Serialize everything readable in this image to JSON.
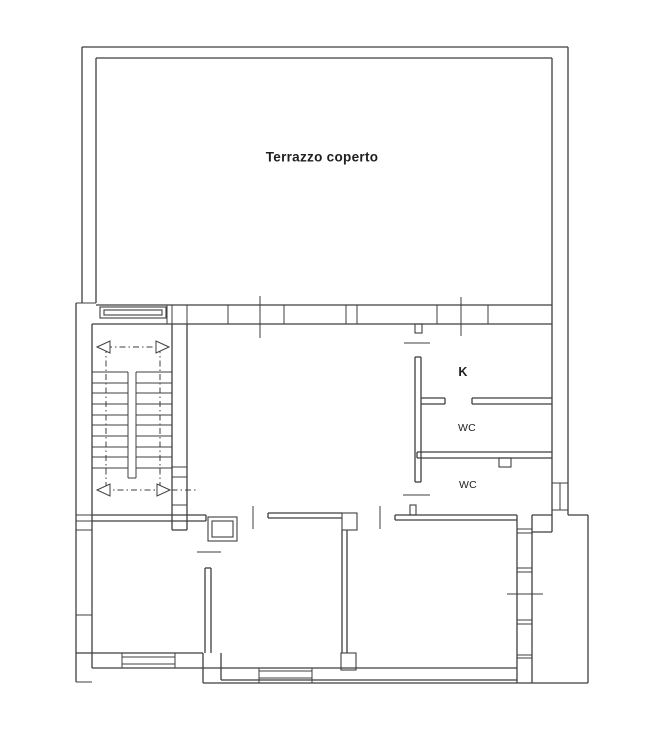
{
  "document": {
    "type": "architectural floor plan",
    "background": "#ffffff"
  },
  "colors": {
    "background": "#ffffff",
    "line": "#3f3f3f",
    "label": "#1e1e1e"
  },
  "labels": [
    {
      "id": "terrace",
      "text": "Terrazzo coperto",
      "x": 322,
      "y": 157,
      "size": 13.5,
      "weight": "bold"
    },
    {
      "id": "kitchen",
      "text": "K",
      "x": 463,
      "y": 372,
      "size": 12.5,
      "weight": "bold"
    },
    {
      "id": "wc-upper",
      "text": "WC",
      "x": 467,
      "y": 428,
      "size": 10.5,
      "weight": "normal"
    },
    {
      "id": "wc-lower",
      "text": "WC",
      "x": 468,
      "y": 485,
      "size": 10.5,
      "weight": "normal"
    }
  ],
  "geometry": {
    "canvas": {
      "w": 662,
      "h": 738
    },
    "wall_lines": [
      [
        82,
        47,
        568,
        47
      ],
      [
        96,
        58,
        552,
        58
      ],
      [
        82,
        47,
        82,
        303
      ],
      [
        96,
        58,
        96,
        303
      ],
      [
        568,
        47,
        568,
        515
      ],
      [
        552,
        58,
        552,
        532
      ],
      [
        96,
        305,
        552,
        305
      ],
      [
        92,
        324,
        552,
        324
      ],
      [
        76,
        303,
        76,
        682
      ],
      [
        92,
        324,
        92,
        668
      ],
      [
        172,
        324,
        172,
        530
      ],
      [
        187,
        324,
        187,
        530
      ],
      [
        172,
        530,
        187,
        530
      ],
      [
        92,
        515,
        206,
        515
      ],
      [
        92,
        521,
        206,
        521
      ],
      [
        206,
        515,
        206,
        521
      ],
      [
        268,
        513,
        342,
        513
      ],
      [
        268,
        518,
        342,
        518
      ],
      [
        268,
        513,
        268,
        518
      ],
      [
        342,
        530,
        342,
        653
      ],
      [
        347,
        530,
        347,
        653
      ],
      [
        395,
        515,
        517,
        515
      ],
      [
        395,
        520,
        517,
        520
      ],
      [
        395,
        515,
        395,
        520
      ],
      [
        415,
        357,
        415,
        482
      ],
      [
        421,
        357,
        421,
        482
      ],
      [
        415,
        357,
        421,
        357
      ],
      [
        415,
        482,
        421,
        482
      ],
      [
        421,
        398,
        445,
        398
      ],
      [
        421,
        404,
        445,
        404
      ],
      [
        445,
        398,
        445,
        404
      ],
      [
        472,
        398,
        552,
        398
      ],
      [
        472,
        404,
        552,
        404
      ],
      [
        472,
        398,
        472,
        404
      ],
      [
        417,
        452,
        552,
        452
      ],
      [
        417,
        458,
        552,
        458
      ],
      [
        417,
        452,
        417,
        458
      ],
      [
        517,
        515,
        517,
        683
      ],
      [
        532,
        515,
        532,
        683
      ],
      [
        532,
        515,
        552,
        515
      ],
      [
        532,
        532,
        552,
        532
      ],
      [
        568,
        515,
        588,
        515
      ],
      [
        588,
        515,
        588,
        683
      ],
      [
        76,
        653,
        203,
        653
      ],
      [
        92,
        668,
        517,
        668
      ],
      [
        221,
        680,
        517,
        680
      ],
      [
        203,
        683,
        588,
        683
      ],
      [
        203,
        653,
        203,
        683
      ],
      [
        221,
        653,
        221,
        680
      ],
      [
        205,
        568,
        205,
        653
      ],
      [
        211,
        568,
        211,
        653
      ],
      [
        205,
        568,
        211,
        568
      ]
    ],
    "thin_lines": [
      [
        167,
        305,
        167,
        324
      ],
      [
        172,
        305,
        172,
        324
      ],
      [
        187,
        305,
        187,
        324
      ],
      [
        228,
        305,
        228,
        324
      ],
      [
        284,
        305,
        284,
        324
      ],
      [
        346,
        305,
        346,
        324
      ],
      [
        357,
        305,
        357,
        324
      ],
      [
        437,
        305,
        437,
        324
      ],
      [
        488,
        305,
        488,
        324
      ],
      [
        260,
        296,
        260,
        338
      ],
      [
        461,
        297,
        461,
        336
      ],
      [
        76,
        303,
        96,
        303
      ],
      [
        76,
        515,
        92,
        515
      ],
      [
        76,
        521,
        92,
        521
      ],
      [
        76,
        530,
        92,
        530
      ],
      [
        76,
        615,
        92,
        615
      ],
      [
        76,
        682,
        92,
        682
      ],
      [
        172,
        467,
        187,
        467
      ],
      [
        172,
        477,
        187,
        477
      ],
      [
        172,
        505,
        187,
        505
      ],
      [
        172,
        515,
        187,
        515
      ],
      [
        92,
        372,
        128,
        372
      ],
      [
        92,
        383,
        128,
        383
      ],
      [
        92,
        393,
        128,
        393
      ],
      [
        92,
        404,
        128,
        404
      ],
      [
        92,
        415,
        128,
        415
      ],
      [
        92,
        425,
        128,
        425
      ],
      [
        92,
        436,
        128,
        436
      ],
      [
        92,
        447,
        128,
        447
      ],
      [
        92,
        457,
        128,
        457
      ],
      [
        92,
        468,
        128,
        468
      ],
      [
        136,
        372,
        172,
        372
      ],
      [
        136,
        383,
        172,
        383
      ],
      [
        136,
        393,
        172,
        393
      ],
      [
        136,
        404,
        172,
        404
      ],
      [
        136,
        415,
        172,
        415
      ],
      [
        136,
        425,
        172,
        425
      ],
      [
        136,
        436,
        172,
        436
      ],
      [
        136,
        447,
        172,
        447
      ],
      [
        136,
        457,
        172,
        457
      ],
      [
        136,
        468,
        172,
        468
      ],
      [
        128,
        372,
        128,
        478
      ],
      [
        136,
        372,
        136,
        478
      ],
      [
        128,
        478,
        136,
        478
      ],
      [
        197,
        552,
        221,
        552
      ],
      [
        253,
        506,
        253,
        529
      ],
      [
        380,
        506,
        380,
        529
      ],
      [
        404,
        343,
        430,
        343
      ],
      [
        403,
        495,
        430,
        495
      ],
      [
        552,
        483,
        568,
        483
      ],
      [
        552,
        510,
        568,
        510
      ],
      [
        560,
        483,
        560,
        510
      ],
      [
        517,
        529,
        532,
        529
      ],
      [
        517,
        533,
        532,
        533
      ],
      [
        517,
        568,
        532,
        568
      ],
      [
        517,
        572,
        532,
        572
      ],
      [
        517,
        620,
        532,
        620
      ],
      [
        517,
        624,
        532,
        624
      ],
      [
        517,
        655,
        532,
        655
      ],
      [
        517,
        658,
        532,
        658
      ],
      [
        507,
        594,
        543,
        594
      ],
      [
        122,
        657,
        175,
        657
      ],
      [
        122,
        664,
        175,
        664
      ],
      [
        122,
        653,
        122,
        668
      ],
      [
        175,
        653,
        175,
        668
      ],
      [
        259,
        671,
        312,
        671
      ],
      [
        259,
        678,
        312,
        678
      ],
      [
        259,
        668,
        259,
        683
      ],
      [
        312,
        668,
        312,
        683
      ]
    ],
    "dashdot_lines": [
      [
        106,
        347,
        160,
        347
      ],
      [
        106,
        347,
        106,
        490
      ],
      [
        160,
        347,
        160,
        490
      ],
      [
        104,
        490,
        198,
        490
      ]
    ],
    "rects": [
      [
        100,
        307,
        66,
        11
      ],
      [
        104,
        310,
        58,
        5
      ],
      [
        208,
        517,
        29,
        24
      ],
      [
        212,
        521,
        21,
        16
      ],
      [
        342,
        513,
        15,
        17
      ],
      [
        341,
        653,
        15,
        17
      ],
      [
        410,
        505,
        6,
        10
      ],
      [
        415,
        324,
        7,
        9
      ],
      [
        499,
        458,
        12,
        9
      ]
    ],
    "arrowheads": [
      [
        97,
        347,
        110,
        341,
        110,
        353
      ],
      [
        169,
        347,
        156,
        341,
        156,
        353
      ],
      [
        97,
        490,
        110,
        484,
        110,
        496
      ],
      [
        170,
        490,
        157,
        484,
        157,
        496
      ]
    ]
  }
}
